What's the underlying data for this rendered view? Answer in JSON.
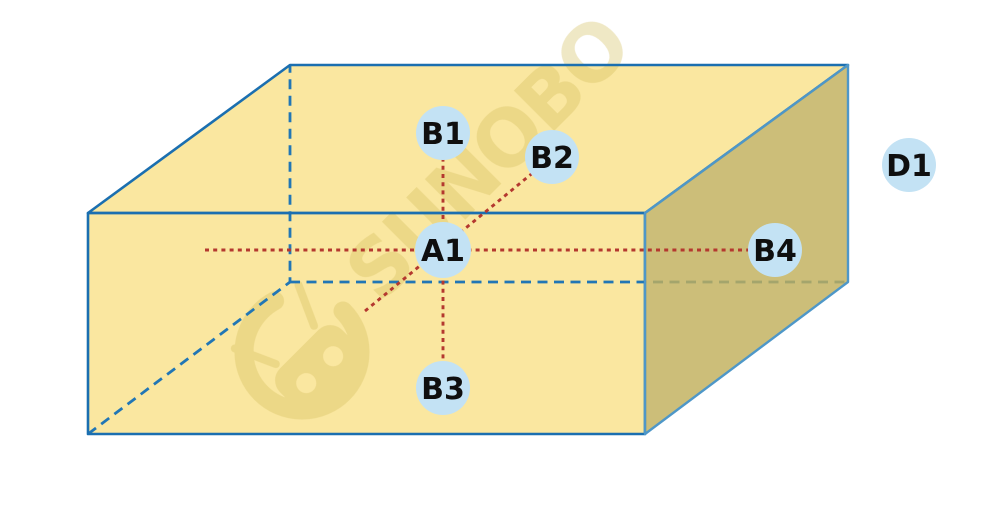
{
  "figure": {
    "type": "cuboid-diagram",
    "points": {
      "a1": {
        "label": "A1",
        "position": "center of front face"
      },
      "b1": {
        "label": "B1",
        "position": "above A1 on top face"
      },
      "b2": {
        "label": "B2",
        "position": "upper-right diagonal from A1"
      },
      "b3": {
        "label": "B3",
        "position": "below A1 on front face"
      },
      "b4": {
        "label": "B4",
        "position": "right of A1 on side face"
      },
      "d1": {
        "label": "D1",
        "position": "outside box, far right"
      }
    }
  },
  "watermark": {
    "text": "SUNOBO",
    "logo": "robot-in-circle-icon"
  },
  "colors": {
    "background": "#FFFFFF",
    "face_fill": "#FAE7A0",
    "side_face_fill": "#C1B05C",
    "edge_blue": "#1B6FB0",
    "side_edge_blue": "#4E97C8",
    "hidden_edge_blue": "#2176B5",
    "guide_red": "#B4382F",
    "point_fill": "#C3E2F4",
    "label_color": "#0F0F0F",
    "watermark_color": "#D2BC5A"
  }
}
